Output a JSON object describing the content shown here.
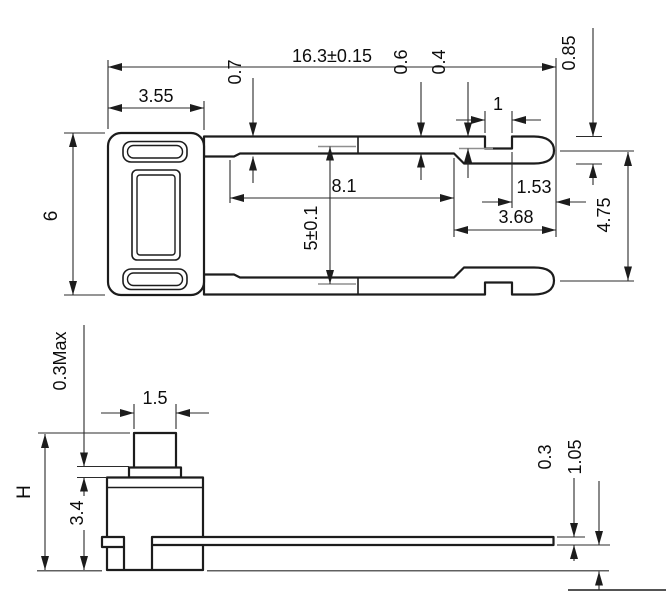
{
  "colors": {
    "background": "#ffffff",
    "part_line": "#1c1c1c",
    "dimension_line": "#2b2b2b",
    "leader_line": "#8f8f8f",
    "text": "#0d0d0d"
  },
  "views": {
    "top": {
      "dims": {
        "overall_length": "16.3±0.15",
        "body_width": "3.55",
        "body_height": "6",
        "pin_base_width": "0.7",
        "pin_mid_width": "0.6",
        "notch_depth": "0.4",
        "notch_width": "1",
        "tip_width": "0.85",
        "pin_straight_length": "8.1",
        "notch_to_tip": "1.53",
        "tip_section_length": "3.68",
        "pin_pitch": "5±0.1",
        "tip_pitch": "4.75"
      }
    },
    "side": {
      "dims": {
        "flange_protrusion": "0.3Max",
        "button_width": "1.5",
        "overall_height": "H",
        "body_height": "3.4",
        "terminal_thickness": "0.3",
        "terminal_standoff": "1.05"
      }
    }
  }
}
